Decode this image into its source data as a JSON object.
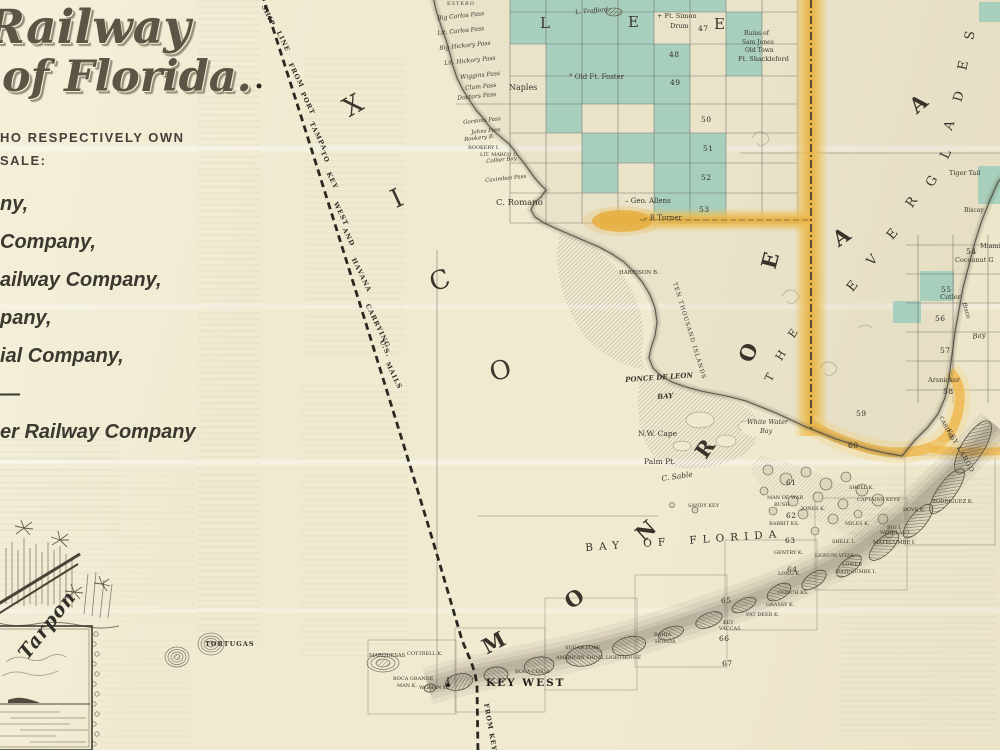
{
  "palette": {
    "paper": "#f0ead1",
    "teal": "#a3d2c1",
    "orange": "#eeb23c",
    "orange_light": "#f5d88e",
    "ink": "#3a362c"
  },
  "panel": {
    "title1": "Railway",
    "title2": "of Florida.",
    "intro1": "HO RESPECTIVELY OWN",
    "intro2": "SALE:",
    "companies": [
      "ny,",
      "Company,",
      "ailway Company,",
      "pany,",
      "ial Company,",
      "—",
      "er Railway Company"
    ],
    "vignette_caption": "Tarpon"
  },
  "map": {
    "route_words": [
      {
        "t": "SHIP",
        "x": 266,
        "y": 4
      },
      {
        "t": "LINE",
        "x": 281,
        "y": 30
      },
      {
        "t": "FROM",
        "x": 293,
        "y": 62
      },
      {
        "t": "PORT",
        "x": 305,
        "y": 91
      },
      {
        "t": "TAMPA",
        "x": 314,
        "y": 121
      },
      {
        "t": "TO",
        "x": 325,
        "y": 150
      },
      {
        "t": "KEY",
        "x": 331,
        "y": 171
      },
      {
        "t": "WEST",
        "x": 338,
        "y": 201
      },
      {
        "t": "AND",
        "x": 347,
        "y": 227
      },
      {
        "t": "HAVANA",
        "x": 356,
        "y": 257
      },
      {
        "t": "CARRYING",
        "x": 370,
        "y": 303
      },
      {
        "t": "U.S.",
        "x": 384,
        "y": 339
      },
      {
        "t": "MAILS",
        "x": 390,
        "y": 361
      },
      {
        "t": "FROM KEY",
        "x": 489,
        "y": 703,
        "r": 80
      }
    ],
    "big_letters": [
      {
        "t": "L",
        "x": 540,
        "y": 16,
        "s": 15
      },
      {
        "t": "E",
        "x": 628,
        "y": 15,
        "s": 15
      },
      {
        "t": "E",
        "x": 714,
        "y": 17,
        "s": 15
      },
      {
        "t": "X",
        "x": 344,
        "y": 93,
        "s": 26,
        "r": -30
      },
      {
        "t": "I",
        "x": 392,
        "y": 186,
        "s": 26,
        "r": -25
      },
      {
        "t": "C",
        "x": 430,
        "y": 268,
        "s": 26,
        "r": -20
      },
      {
        "t": "O",
        "x": 490,
        "y": 358,
        "s": 26,
        "r": -15
      },
      {
        "t": "M",
        "x": 482,
        "y": 632,
        "s": 21,
        "r": -28,
        "b": 1
      },
      {
        "t": "O",
        "x": 565,
        "y": 588,
        "s": 21,
        "r": -35,
        "b": 1
      },
      {
        "t": "N",
        "x": 636,
        "y": 520,
        "s": 21,
        "r": -42,
        "b": 1
      },
      {
        "t": "R",
        "x": 696,
        "y": 438,
        "s": 21,
        "r": -55,
        "b": 1
      },
      {
        "t": "O",
        "x": 739,
        "y": 342,
        "s": 21,
        "r": -68,
        "b": 1
      },
      {
        "t": "E",
        "x": 762,
        "y": 250,
        "s": 21,
        "r": -75,
        "b": 1
      },
      {
        "t": "A",
        "x": 833,
        "y": 226,
        "s": 21,
        "r": -35,
        "b": 1
      },
      {
        "t": "A",
        "x": 910,
        "y": 93,
        "s": 21,
        "r": -40,
        "b": 1
      },
      {
        "t": "T",
        "x": 766,
        "y": 372,
        "s": 11,
        "r": -62
      },
      {
        "t": "H",
        "x": 776,
        "y": 350,
        "s": 11,
        "r": -58
      },
      {
        "t": "E",
        "x": 789,
        "y": 328,
        "s": 11,
        "r": -55
      },
      {
        "t": "E",
        "x": 848,
        "y": 280,
        "s": 13,
        "r": -50
      },
      {
        "t": "V",
        "x": 868,
        "y": 254,
        "s": 13,
        "r": -48
      },
      {
        "t": "E",
        "x": 888,
        "y": 228,
        "s": 13,
        "r": -50
      },
      {
        "t": "R",
        "x": 907,
        "y": 196,
        "s": 13,
        "r": -55
      },
      {
        "t": "G",
        "x": 927,
        "y": 175,
        "s": 13,
        "r": -60
      },
      {
        "t": "L",
        "x": 942,
        "y": 148,
        "s": 13,
        "r": -65
      },
      {
        "t": "A",
        "x": 945,
        "y": 119,
        "s": 13,
        "r": -70
      },
      {
        "t": "D",
        "x": 954,
        "y": 90,
        "s": 13,
        "r": -75
      },
      {
        "t": "E",
        "x": 959,
        "y": 59,
        "s": 13,
        "r": -78
      },
      {
        "t": "S",
        "x": 966,
        "y": 29,
        "s": 13,
        "r": -80
      }
    ],
    "townships": [
      {
        "n": "47",
        "x": 698,
        "y": 25
      },
      {
        "n": "48",
        "x": 669,
        "y": 51
      },
      {
        "n": "49",
        "x": 670,
        "y": 79
      },
      {
        "n": "50",
        "x": 701,
        "y": 116
      },
      {
        "n": "51",
        "x": 703,
        "y": 145
      },
      {
        "n": "52",
        "x": 701,
        "y": 174
      },
      {
        "n": "53",
        "x": 699,
        "y": 206
      },
      {
        "n": "54",
        "x": 966,
        "y": 248
      },
      {
        "n": "55",
        "x": 941,
        "y": 286
      },
      {
        "n": "56",
        "x": 935,
        "y": 315
      },
      {
        "n": "57",
        "x": 940,
        "y": 347
      },
      {
        "n": "58",
        "x": 943,
        "y": 388
      },
      {
        "n": "59",
        "x": 856,
        "y": 410
      },
      {
        "n": "60",
        "x": 848,
        "y": 442
      },
      {
        "n": "61",
        "x": 786,
        "y": 479
      },
      {
        "n": "62",
        "x": 786,
        "y": 512
      },
      {
        "n": "63",
        "x": 785,
        "y": 537
      },
      {
        "n": "64",
        "x": 787,
        "y": 566
      },
      {
        "n": "65",
        "x": 721,
        "y": 597
      },
      {
        "n": "66",
        "x": 719,
        "y": 635
      },
      {
        "n": "67",
        "x": 722,
        "y": 660
      }
    ],
    "labels": [
      {
        "t": "ESTERO",
        "x": 447,
        "y": 2,
        "s": 5,
        "c": "sp"
      },
      {
        "t": "Big Carlos Pass",
        "x": 437,
        "y": 16,
        "s": 6,
        "r": -6,
        "c": "i"
      },
      {
        "t": "Lit. Carlos Pass",
        "x": 437,
        "y": 31,
        "s": 6,
        "r": -6,
        "c": "i"
      },
      {
        "t": "Big Hickory Pass",
        "x": 439,
        "y": 46,
        "s": 6,
        "r": -6,
        "c": "i"
      },
      {
        "t": "Lit. Hickory Pass",
        "x": 444,
        "y": 61,
        "s": 6,
        "r": -6,
        "c": "i"
      },
      {
        "t": "Wiggins Pass",
        "x": 460,
        "y": 75,
        "s": 6,
        "r": -6,
        "c": "i"
      },
      {
        "t": "Clam Pass",
        "x": 465,
        "y": 86,
        "s": 6,
        "r": -6,
        "c": "i"
      },
      {
        "t": "Doctors Pass",
        "x": 457,
        "y": 96,
        "s": 6,
        "r": -6,
        "c": "i"
      },
      {
        "t": "Naples",
        "x": 509,
        "y": 84,
        "s": 8
      },
      {
        "t": "Gordons Pass",
        "x": 463,
        "y": 121,
        "s": 5.5,
        "r": -6,
        "c": "i"
      },
      {
        "t": "Johns Pass",
        "x": 471,
        "y": 131,
        "s": 5.5,
        "r": -6,
        "c": "i"
      },
      {
        "t": "Rookery B.",
        "x": 464,
        "y": 138,
        "s": 5.5,
        "r": -6,
        "c": "i"
      },
      {
        "t": "ROOKERY I.",
        "x": 468,
        "y": 146,
        "s": 5
      },
      {
        "t": "LIT. MARCO I.",
        "x": 480,
        "y": 153,
        "s": 5
      },
      {
        "t": "Collier Bay",
        "x": 486,
        "y": 160,
        "s": 5.5,
        "r": -6,
        "c": "i"
      },
      {
        "t": "Caximbas Pass",
        "x": 485,
        "y": 179,
        "s": 5.5,
        "r": -6,
        "c": "i"
      },
      {
        "t": "C. Romano",
        "x": 496,
        "y": 199,
        "s": 8.5
      },
      {
        "t": "L. Trafford",
        "x": 575,
        "y": 10,
        "s": 6,
        "r": -5,
        "c": "i"
      },
      {
        "t": "+ Ft. Simon",
        "x": 657,
        "y": 13,
        "s": 6.5
      },
      {
        "t": "Drum",
        "x": 670,
        "y": 23,
        "s": 6.5
      },
      {
        "t": "° Old Ft. Foster",
        "x": 569,
        "y": 74,
        "s": 7
      },
      {
        "t": "Ruins of",
        "x": 744,
        "y": 31,
        "s": 6
      },
      {
        "t": "Sam Jones",
        "x": 742,
        "y": 40,
        "s": 6
      },
      {
        "t": "Old Town",
        "x": 745,
        "y": 48,
        "s": 6
      },
      {
        "t": "Ft. Shackleford",
        "x": 738,
        "y": 56,
        "s": 6.5
      },
      {
        "t": "– Geo. Allens",
        "x": 625,
        "y": 198,
        "s": 7
      },
      {
        "t": "– R.Turner",
        "x": 644,
        "y": 215,
        "s": 7
      },
      {
        "t": "HARRISON B.",
        "x": 619,
        "y": 271,
        "s": 5.5
      },
      {
        "t": "TEN THOUSAND ISLANDS",
        "x": 676,
        "y": 282,
        "s": 5.8,
        "r": 73,
        "c": "sp"
      },
      {
        "t": "PONCE DE LEON",
        "x": 625,
        "y": 376,
        "s": 7,
        "r": -4,
        "c": "i b"
      },
      {
        "t": "BAY",
        "x": 657,
        "y": 393,
        "s": 7,
        "r": -4,
        "c": "i b"
      },
      {
        "t": "White Water",
        "x": 747,
        "y": 419,
        "s": 6.5,
        "c": "i"
      },
      {
        "t": "Bay",
        "x": 760,
        "y": 428,
        "s": 6.5,
        "c": "i"
      },
      {
        "t": "N.W. Cape",
        "x": 638,
        "y": 430,
        "s": 7.5
      },
      {
        "t": "Palm Pt.",
        "x": 644,
        "y": 458,
        "s": 7.5
      },
      {
        "t": "C. Sable",
        "x": 661,
        "y": 475,
        "s": 7.5,
        "r": -8,
        "c": "i"
      },
      {
        "t": "SANDY KEY",
        "x": 688,
        "y": 504,
        "s": 5
      },
      {
        "t": "Tiger Tail",
        "x": 949,
        "y": 170,
        "s": 6.5
      },
      {
        "t": "Biscay",
        "x": 964,
        "y": 208,
        "s": 6
      },
      {
        "t": "Miami",
        "x": 980,
        "y": 243,
        "s": 6.5
      },
      {
        "t": "Cocoanut G",
        "x": 955,
        "y": 257,
        "s": 6.5
      },
      {
        "t": "Cutler",
        "x": 940,
        "y": 294,
        "s": 6.5
      },
      {
        "t": "Bisca",
        "x": 966,
        "y": 302,
        "s": 6,
        "r": 72,
        "c": "i"
      },
      {
        "t": "Bay",
        "x": 972,
        "y": 334,
        "s": 7,
        "r": -10,
        "c": "i"
      },
      {
        "t": "Arsnicker",
        "x": 928,
        "y": 377,
        "s": 6.5
      },
      {
        "t": "CARD SD",
        "x": 942,
        "y": 416,
        "s": 5.5,
        "r": 64
      },
      {
        "t": "KEY LARGO",
        "x": 951,
        "y": 428,
        "s": 6.5,
        "r": 60,
        "c": "sp"
      },
      {
        "t": "MAN OF WAR",
        "x": 767,
        "y": 496,
        "s": 5
      },
      {
        "t": "BUSH",
        "x": 774,
        "y": 503,
        "s": 5
      },
      {
        "t": "JONES K.",
        "x": 801,
        "y": 507,
        "s": 5
      },
      {
        "t": "RABBIT KS.",
        "x": 769,
        "y": 522,
        "s": 5
      },
      {
        "t": "SHELL K.",
        "x": 849,
        "y": 486,
        "s": 5
      },
      {
        "t": "CAPTAINS KEYS",
        "x": 857,
        "y": 498,
        "s": 5
      },
      {
        "t": "RODRIGUEZ K.",
        "x": 932,
        "y": 500,
        "s": 5.2
      },
      {
        "t": "DOVE K.",
        "x": 903,
        "y": 508,
        "s": 5
      },
      {
        "t": "MILES K.",
        "x": 845,
        "y": 522,
        "s": 5
      },
      {
        "t": "BIG I.",
        "x": 887,
        "y": 526,
        "s": 5
      },
      {
        "t": "WINDLAS I.",
        "x": 880,
        "y": 531,
        "s": 5
      },
      {
        "t": "MATECUMBE I.",
        "x": 873,
        "y": 541,
        "s": 5.2
      },
      {
        "t": "SHELL I.",
        "x": 832,
        "y": 540,
        "s": 5
      },
      {
        "t": "GENTRY K.",
        "x": 774,
        "y": 551,
        "s": 5
      },
      {
        "t": "LIGNUM VITAE",
        "x": 815,
        "y": 555,
        "s": 4.8
      },
      {
        "t": "LOWER",
        "x": 842,
        "y": 563,
        "s": 5
      },
      {
        "t": "MATECUMBE I.",
        "x": 835,
        "y": 570,
        "s": 5
      },
      {
        "t": "LONG K.",
        "x": 778,
        "y": 572,
        "s": 5
      },
      {
        "t": "CONCH KS.",
        "x": 778,
        "y": 591,
        "s": 5
      },
      {
        "t": "GRASSY K.",
        "x": 766,
        "y": 603,
        "s": 5
      },
      {
        "t": "FAT DEER K.",
        "x": 746,
        "y": 613,
        "s": 5
      },
      {
        "t": "KEY",
        "x": 723,
        "y": 621,
        "s": 5
      },
      {
        "t": "VACCAS",
        "x": 719,
        "y": 627,
        "s": 5
      },
      {
        "t": "BAHIA",
        "x": 654,
        "y": 633,
        "s": 5
      },
      {
        "t": "HONDA",
        "x": 655,
        "y": 640,
        "s": 5
      },
      {
        "t": "SUGAR LOAF",
        "x": 565,
        "y": 646,
        "s": 5
      },
      {
        "t": "AMERICAN SHOAL LIGHTHOUSE",
        "x": 556,
        "y": 657,
        "s": 4.8
      },
      {
        "t": "BOCA CHICA",
        "x": 515,
        "y": 670,
        "s": 5
      },
      {
        "t": "KEY WEST",
        "x": 486,
        "y": 678,
        "s": 10.5,
        "c": "kw"
      },
      {
        "t": "MARQUESAS",
        "x": 369,
        "y": 654,
        "s": 5.2
      },
      {
        "t": "COTTRELL K.",
        "x": 407,
        "y": 652,
        "s": 5
      },
      {
        "t": "BOCA GRANDE",
        "x": 393,
        "y": 677,
        "s": 5
      },
      {
        "t": "MAN K.",
        "x": 397,
        "y": 684,
        "s": 5
      },
      {
        "t": "WOMAN K.",
        "x": 419,
        "y": 686,
        "s": 5
      },
      {
        "t": "TORTUGAS",
        "x": 205,
        "y": 641,
        "s": 6.5,
        "c": "b sp"
      },
      {
        "t": "BAY OF FLORIDA",
        "x": 585,
        "y": 543,
        "s": 10.5,
        "r": -4,
        "c": "spread"
      }
    ],
    "grid": {
      "cols": [
        510,
        546,
        582,
        618,
        654,
        690,
        726,
        762,
        798
      ],
      "rows": [
        0,
        12,
        44,
        76,
        104,
        133,
        163,
        193,
        223
      ],
      "cells": [
        [
          0,
          0
        ],
        [
          1,
          0
        ],
        [
          2,
          0
        ],
        [
          3,
          0
        ],
        [
          4,
          0
        ],
        [
          5,
          0
        ],
        [
          0,
          1
        ],
        [
          1,
          1
        ],
        [
          2,
          1
        ],
        [
          3,
          1
        ],
        [
          6,
          1
        ],
        [
          1,
          2
        ],
        [
          2,
          2
        ],
        [
          3,
          2
        ],
        [
          4,
          2
        ],
        [
          6,
          2
        ],
        [
          1,
          3
        ],
        [
          2,
          3
        ],
        [
          3,
          3
        ],
        [
          4,
          3
        ],
        [
          1,
          4
        ],
        [
          4,
          4
        ],
        [
          2,
          5
        ],
        [
          3,
          5
        ],
        [
          4,
          5
        ],
        [
          5,
          5
        ],
        [
          2,
          6
        ],
        [
          4,
          6
        ],
        [
          5,
          6
        ],
        [
          4,
          7
        ],
        [
          5,
          7
        ]
      ],
      "extra": [
        [
          978,
          166,
          22,
          38
        ],
        [
          979,
          2,
          21,
          20
        ],
        [
          920,
          271,
          34,
          30
        ],
        [
          893,
          301,
          28,
          22
        ]
      ]
    }
  }
}
